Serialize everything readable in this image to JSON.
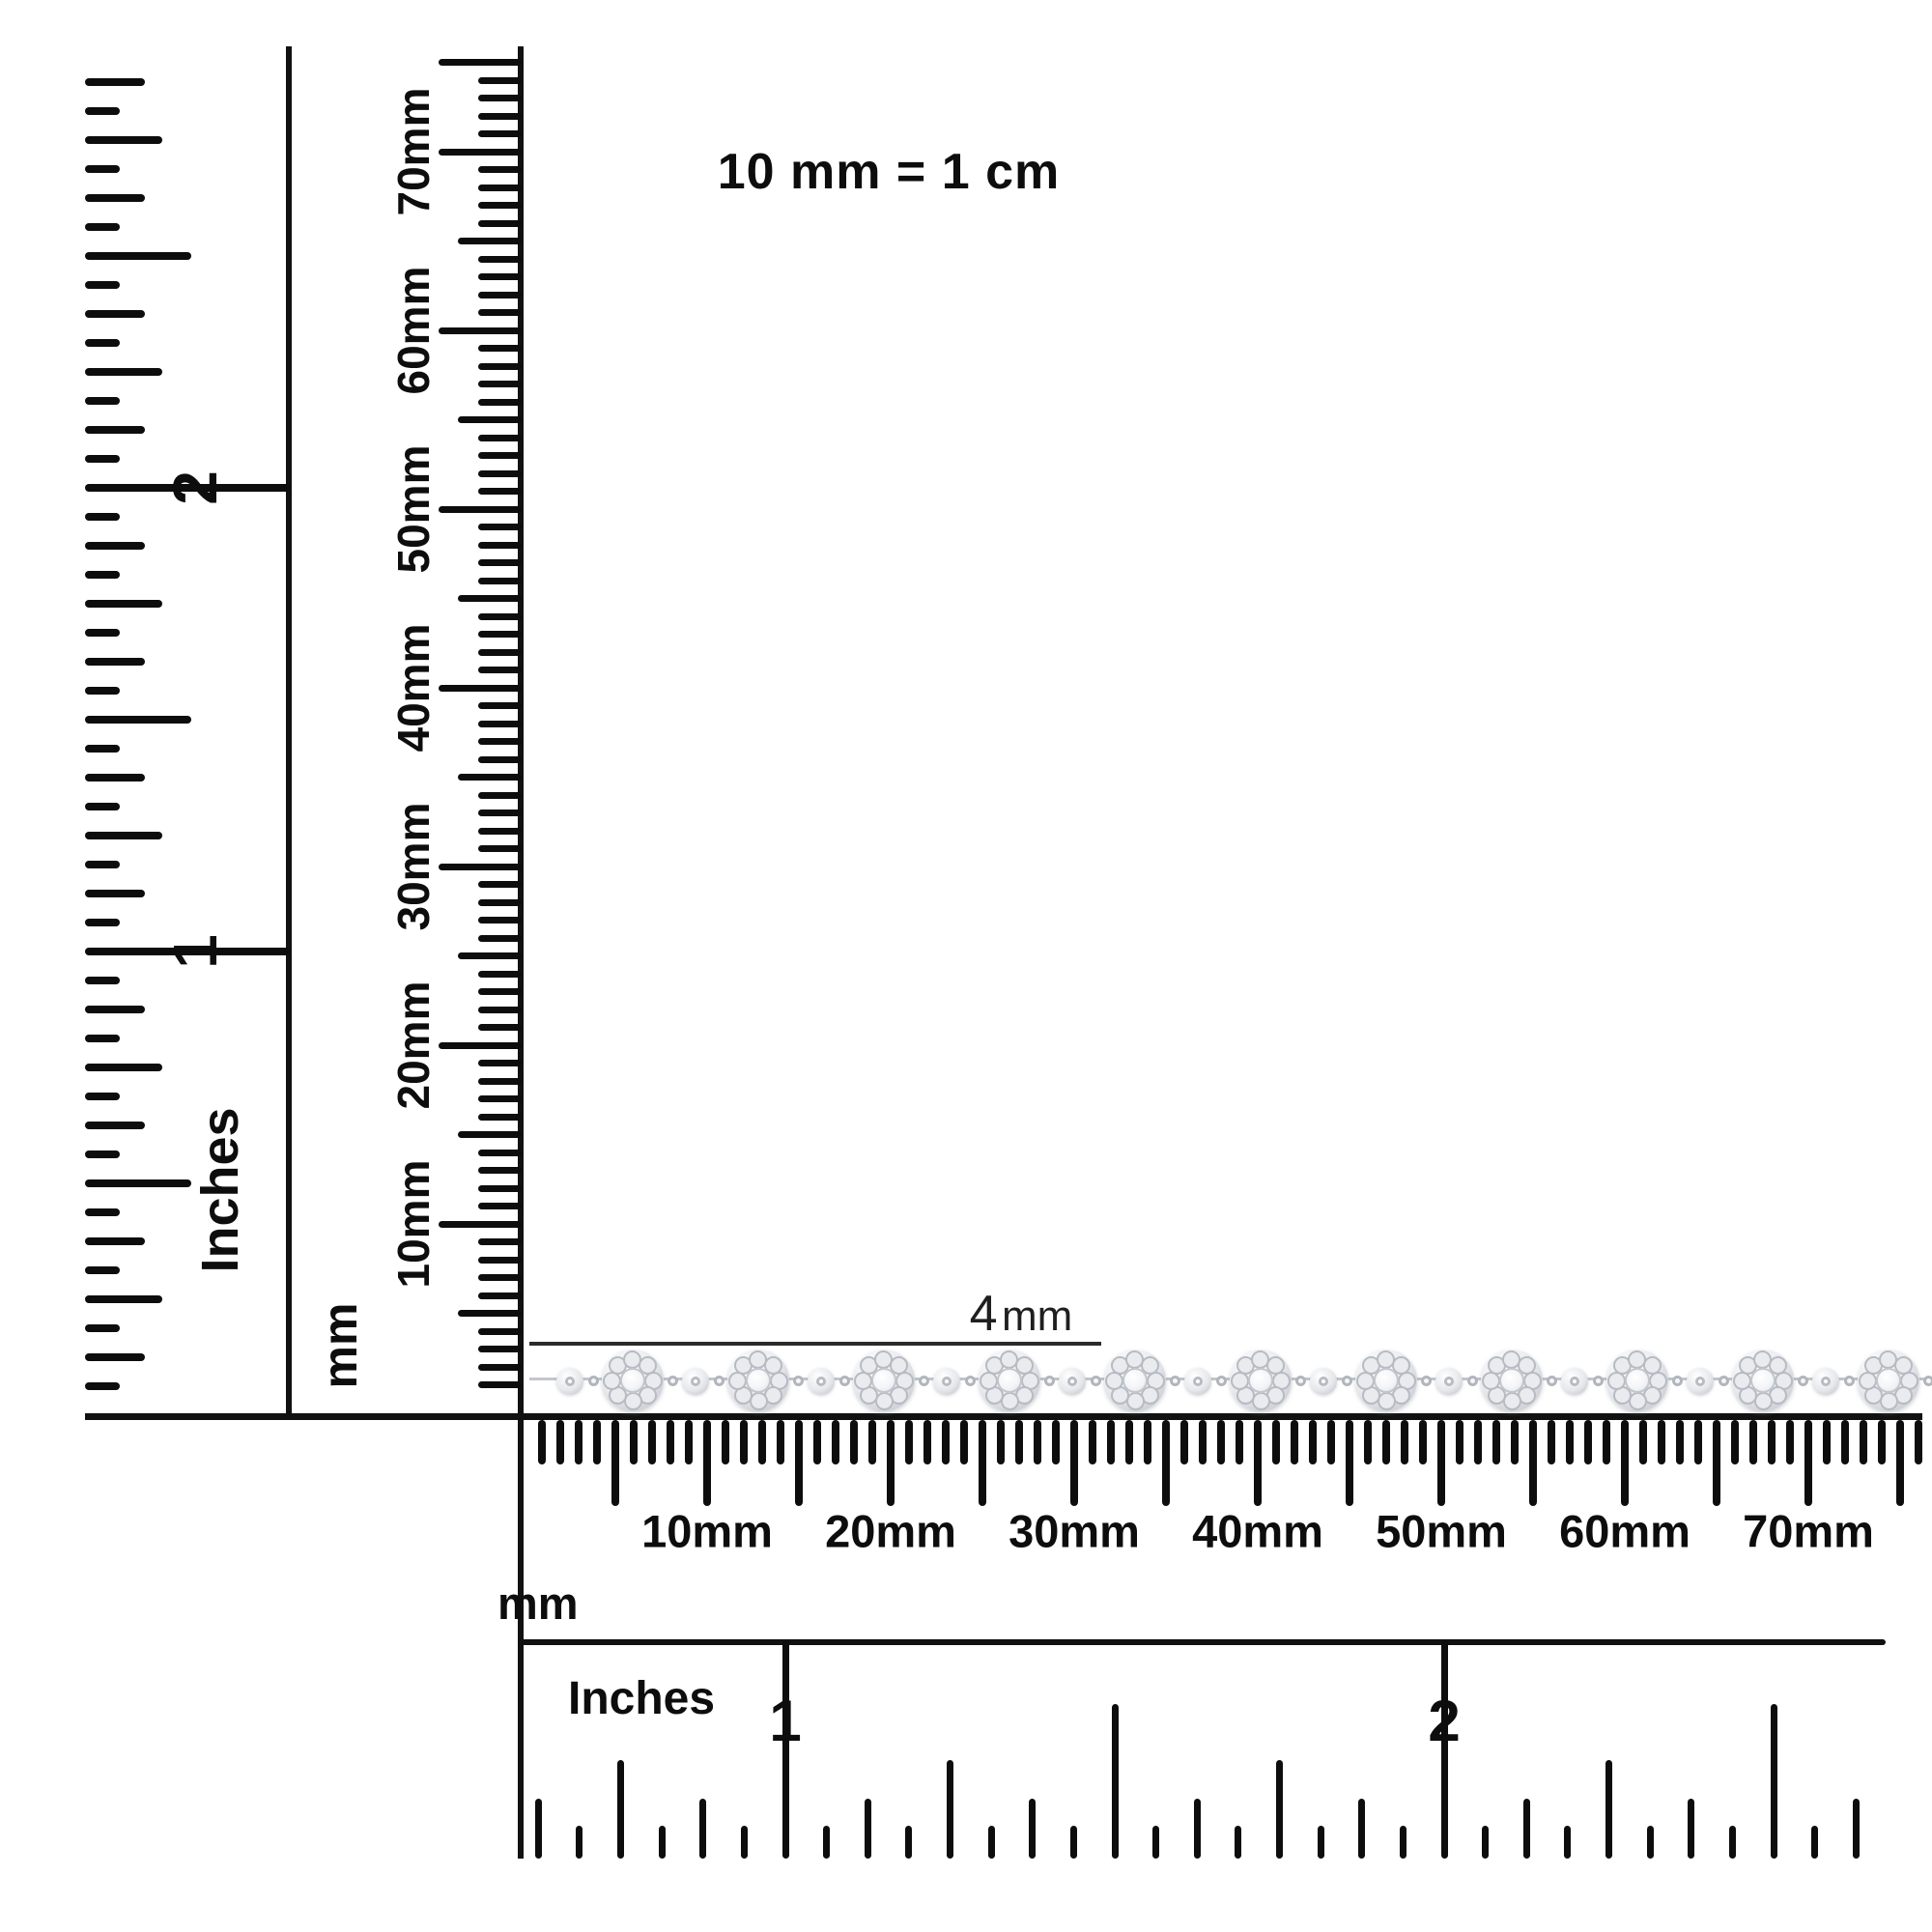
{
  "header": {
    "scale_note": "10 mm = 1 cm"
  },
  "annotation": {
    "text": "4 mm",
    "value": "4",
    "unit": "mm"
  },
  "rulers": {
    "left_inches": {
      "unit_label": "Inches",
      "numbers": [
        "1",
        "2"
      ]
    },
    "vertical_mm": {
      "unit_label": "mm",
      "tick_labels": [
        "10mm",
        "20mm",
        "30mm",
        "40mm",
        "50mm",
        "60mm",
        "70mm"
      ]
    },
    "bottom_mm": {
      "unit_label": "mm",
      "tick_labels": [
        "10mm",
        "20mm",
        "30mm",
        "40mm",
        "50mm",
        "60mm",
        "70mm"
      ]
    },
    "bottom_inches": {
      "unit_label": "Inches",
      "numbers": [
        "1",
        "2"
      ]
    }
  },
  "chain": {
    "kind": "diamond-cluster-bracelet",
    "cluster_count": 11,
    "bead_count": 11,
    "measured_width_label": "4 mm"
  },
  "colors": {
    "ink": "#0d0d0d",
    "annotation_ink": "#1f1f1f",
    "silver_dark": "#abafb7",
    "silver_mid": "#d6d9de",
    "silver_light": "#f4f5f7",
    "background": "#ffffff"
  }
}
